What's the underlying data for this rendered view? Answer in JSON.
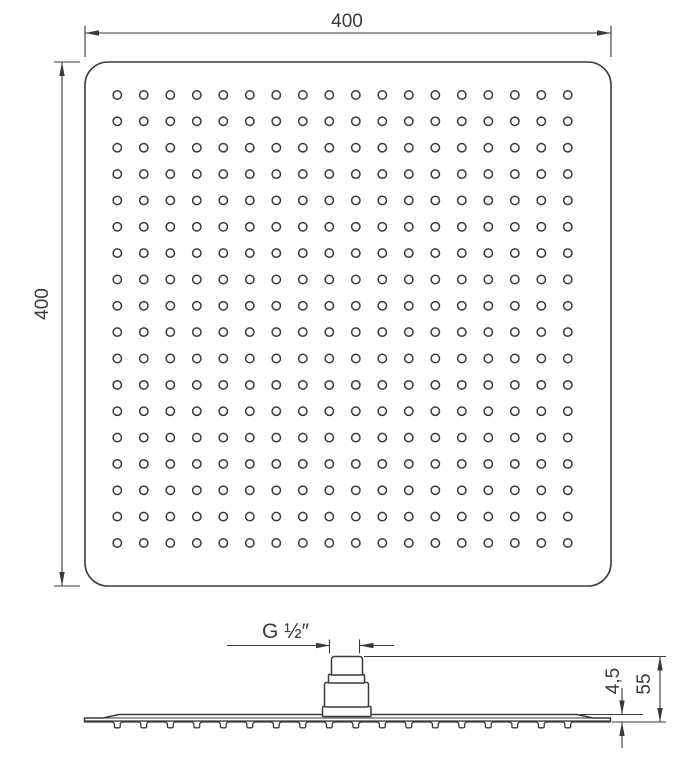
{
  "drawing": {
    "line_color": "#3a3a3a",
    "background_color": "#ffffff",
    "top_view": {
      "width_label": "400",
      "height_label": "400",
      "nozzle_rows": 18,
      "nozzle_cols": 18
    },
    "side_view": {
      "thread_label": "G ½″",
      "overall_height_label": "55",
      "plate_thickness_label": "4,5",
      "nozzle_count": 18
    }
  }
}
